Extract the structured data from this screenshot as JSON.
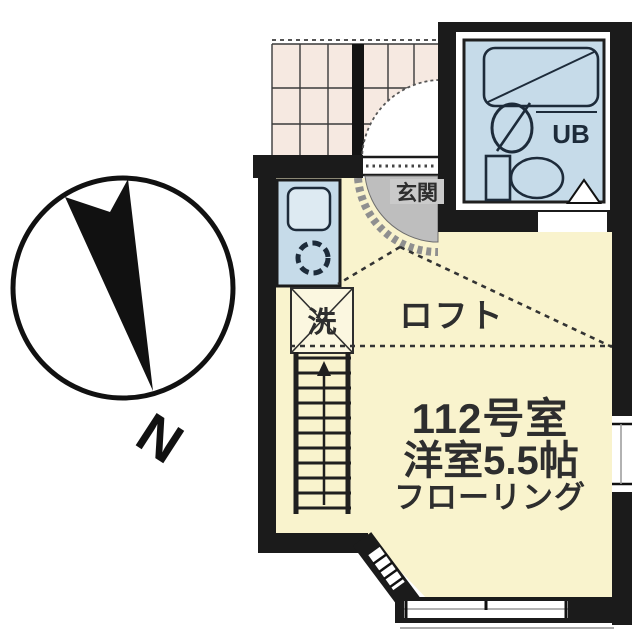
{
  "compass": {
    "north_label": "N"
  },
  "labels": {
    "room_number": "112号室",
    "room_type_size": "洋室5.5帖",
    "flooring": "フローリング",
    "loft": "ロフト",
    "entrance": "玄関",
    "unit_bath": "UB",
    "washing_machine": "洗"
  },
  "colors": {
    "wall": "#1b1b1b",
    "room_fill": "#F9F3CD",
    "corridor_fill": "#F6E9E1",
    "water_fill": "#C6DBE9",
    "fixture_fill": "#DDEAF2",
    "entrance_fill": "#BEBEBE",
    "entrance_label_bg": "#CACACA",
    "label_text": "#2e2e2e",
    "bath_line": "#1d2b3a"
  }
}
